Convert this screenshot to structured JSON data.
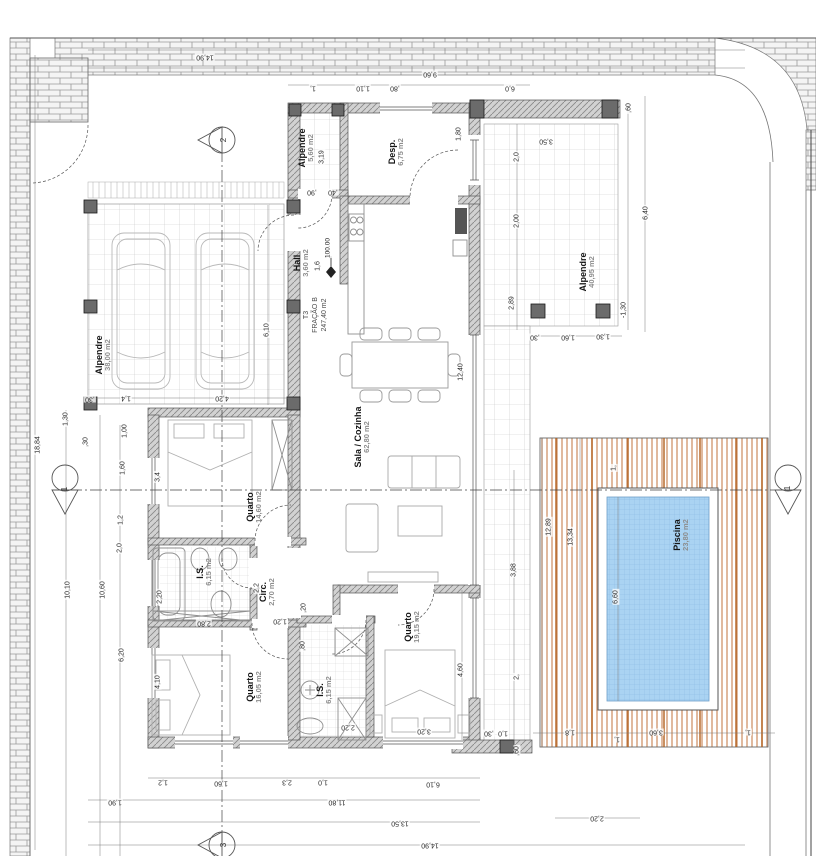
{
  "plan": {
    "fraction_label": {
      "line1": "T3",
      "line2": "FRAÇÃO B",
      "line3": "247,40 m2"
    },
    "level_marker": "100.00",
    "rooms": [
      {
        "name": "Alpendre",
        "area": "38,00 m2",
        "x": 103,
        "y": 355
      },
      {
        "name": "Alpendre",
        "area": "5,60 m2",
        "x": 306,
        "y": 148
      },
      {
        "name": "Desp.",
        "area": "6,75 m2",
        "x": 396,
        "y": 152
      },
      {
        "name": "Hall",
        "area": "3,60 m2",
        "x": 301,
        "y": 263
      },
      {
        "name": "Sala / Cozinha",
        "area": "62,80 m2",
        "x": 362,
        "y": 437
      },
      {
        "name": "Quarto",
        "area": "14,60 m2",
        "x": 254,
        "y": 507
      },
      {
        "name": "I.S.",
        "area": "6,15 m2",
        "x": 204,
        "y": 572
      },
      {
        "name": "Circ.",
        "area": "2,70 m2",
        "x": 267,
        "y": 592
      },
      {
        "name": "Quarto",
        "area": "16,05 m2",
        "x": 254,
        "y": 687
      },
      {
        "name": "I.S.",
        "area": "6,15 m2",
        "x": 324,
        "y": 690
      },
      {
        "name": "Quarto",
        "area": "19,15 m2",
        "x": 412,
        "y": 627
      },
      {
        "name": "Alpendre",
        "area": "40,95 m2",
        "x": 587,
        "y": 272
      },
      {
        "name": "Piscina",
        "area": "23,80 m2",
        "x": 681,
        "y": 535
      }
    ],
    "dimensions": [
      {
        "t": "14,90",
        "x": 205,
        "y": 57,
        "r": 180
      },
      {
        "t": "9,60",
        "x": 430,
        "y": 74,
        "r": 180
      },
      {
        "t": "1,",
        "x": 313,
        "y": 88,
        "r": 180
      },
      {
        "t": "1,10",
        "x": 363,
        "y": 88,
        "r": 180
      },
      {
        "t": ",80",
        "x": 395,
        "y": 88,
        "r": 180
      },
      {
        "t": "6,0",
        "x": 510,
        "y": 88,
        "r": 180
      },
      {
        "t": "3,19",
        "x": 322,
        "y": 157,
        "r": -90
      },
      {
        "t": ",90",
        "x": 312,
        "y": 192,
        "r": 180
      },
      {
        "t": ",40",
        "x": 333,
        "y": 192,
        "r": 180
      },
      {
        "t": "1,80",
        "x": 459,
        "y": 134,
        "r": -90
      },
      {
        "t": "3,50",
        "x": 546,
        "y": 141,
        "r": 180
      },
      {
        "t": ",60",
        "x": 629,
        "y": 108,
        "r": -90
      },
      {
        "t": "6,40",
        "x": 646,
        "y": 213,
        "r": -90
      },
      {
        "t": "2,0",
        "x": 517,
        "y": 157,
        "r": -90
      },
      {
        "t": "2,00",
        "x": 517,
        "y": 221,
        "r": -90
      },
      {
        "t": "2,89",
        "x": 512,
        "y": 303,
        "r": -90
      },
      {
        "t": "-1,30",
        "x": 624,
        "y": 310,
        "r": -90
      },
      {
        "t": ",30",
        "x": 535,
        "y": 337,
        "r": 180
      },
      {
        "t": "1,60",
        "x": 568,
        "y": 337,
        "r": 180
      },
      {
        "t": "1,30",
        "x": 603,
        "y": 336,
        "r": 180
      },
      {
        "t": "3,88",
        "x": 514,
        "y": 570,
        "r": -90
      },
      {
        "t": "2,",
        "x": 517,
        "y": 677,
        "r": -90
      },
      {
        "t": "12,89",
        "x": 549,
        "y": 527,
        "r": -90
      },
      {
        "t": "13,34",
        "x": 571,
        "y": 537,
        "r": -90
      },
      {
        "t": "6,60",
        "x": 616,
        "y": 597,
        "r": -90
      },
      {
        "t": "1,",
        "x": 614,
        "y": 468,
        "r": -90
      },
      {
        "t": "1,8",
        "x": 570,
        "y": 732,
        "r": 180
      },
      {
        "t": "1,",
        "x": 617,
        "y": 739,
        "r": 180
      },
      {
        "t": "3,60",
        "x": 656,
        "y": 732,
        "r": 180
      },
      {
        "t": "1,",
        "x": 748,
        "y": 732,
        "r": 180
      },
      {
        "t": "2,20",
        "x": 597,
        "y": 818,
        "r": 180
      },
      {
        "t": ",60",
        "x": 517,
        "y": 751,
        "r": -90
      },
      {
        "t": "1,0",
        "x": 503,
        "y": 733,
        "r": 180
      },
      {
        "t": ",30",
        "x": 489,
        "y": 733,
        "r": 180
      },
      {
        "t": "1,2",
        "x": 163,
        "y": 782,
        "r": 180
      },
      {
        "t": "1,60",
        "x": 221,
        "y": 783,
        "r": 180
      },
      {
        "t": "2,3",
        "x": 287,
        "y": 782,
        "r": 180
      },
      {
        "t": "1,0",
        "x": 323,
        "y": 782,
        "r": 180
      },
      {
        "t": "6,10",
        "x": 433,
        "y": 784,
        "r": 180
      },
      {
        "t": "1,90",
        "x": 115,
        "y": 802,
        "r": 180
      },
      {
        "t": "11,80",
        "x": 337,
        "y": 802,
        "r": 180
      },
      {
        "t": "13,50",
        "x": 400,
        "y": 823,
        "r": 180
      },
      {
        "t": "14,90",
        "x": 430,
        "y": 845,
        "r": 180
      },
      {
        "t": "18,84",
        "x": 38,
        "y": 445,
        "r": -90
      },
      {
        "t": "10,10",
        "x": 68,
        "y": 590,
        "r": -90
      },
      {
        "t": "10,60",
        "x": 103,
        "y": 590,
        "r": -90
      },
      {
        "t": "6,20",
        "x": 122,
        "y": 655,
        "r": -90
      },
      {
        "t": "1,30",
        "x": 66,
        "y": 419,
        "r": -90
      },
      {
        "t": ",30",
        "x": 86,
        "y": 442,
        "r": -90
      },
      {
        "t": "1,00",
        "x": 125,
        "y": 431,
        "r": -90
      },
      {
        "t": "1,60",
        "x": 123,
        "y": 468,
        "r": -90
      },
      {
        "t": "1,2",
        "x": 121,
        "y": 520,
        "r": -90
      },
      {
        "t": "2,0",
        "x": 120,
        "y": 548,
        "r": -90
      },
      {
        "t": "3,4",
        "x": 158,
        "y": 477,
        "r": -90
      },
      {
        "t": "2,20",
        "x": 160,
        "y": 597,
        "r": -90
      },
      {
        "t": "4,10",
        "x": 158,
        "y": 682,
        "r": -90
      },
      {
        "t": "6,10",
        "x": 267,
        "y": 330,
        "r": -90
      },
      {
        "t": "4,20",
        "x": 222,
        "y": 398,
        "r": 180
      },
      {
        "t": "1,4",
        "x": 126,
        "y": 398,
        "r": 180
      },
      {
        "t": ",30",
        "x": 90,
        "y": 399,
        "r": 180
      },
      {
        "t": "12,40",
        "x": 461,
        "y": 372,
        "r": -90
      },
      {
        "t": "1,6",
        "x": 318,
        "y": 266,
        "r": -90
      },
      {
        "t": "2,2",
        "x": 257,
        "y": 588,
        "r": -90
      },
      {
        "t": "1,20",
        "x": 280,
        "y": 621,
        "r": 180
      },
      {
        "t": "2,80",
        "x": 204,
        "y": 623,
        "r": 180
      },
      {
        "t": ",20",
        "x": 304,
        "y": 608,
        "r": -90
      },
      {
        "t": ",80",
        "x": 303,
        "y": 646,
        "r": -90
      },
      {
        "t": "2,20",
        "x": 348,
        "y": 727,
        "r": 180
      },
      {
        "t": "3,20",
        "x": 424,
        "y": 731,
        "r": 180
      },
      {
        "t": "4,60",
        "x": 461,
        "y": 670,
        "r": -90
      }
    ],
    "section_markers": [
      {
        "label": "2",
        "x": 224,
        "y": 140
      },
      {
        "label": "3",
        "x": 224,
        "y": 845
      },
      {
        "label": "1",
        "x": 65,
        "y": 489
      },
      {
        "label": "1",
        "x": 788,
        "y": 488
      }
    ]
  },
  "colors": {
    "pool_water": "#aad3f2",
    "pool_grid": "#88b9e2",
    "deck_stripe": "#d29b74",
    "deck_joist": "#b2601f",
    "wall_fill": "#d2d2d2",
    "wall_hatch": "#8a8a8a",
    "column": "#6b6b6b",
    "tile_line": "#c8c8c8",
    "brick_line": "#9a9a9a",
    "dim_text": "#2a2a2a",
    "area_text": "#8e8e8e"
  }
}
